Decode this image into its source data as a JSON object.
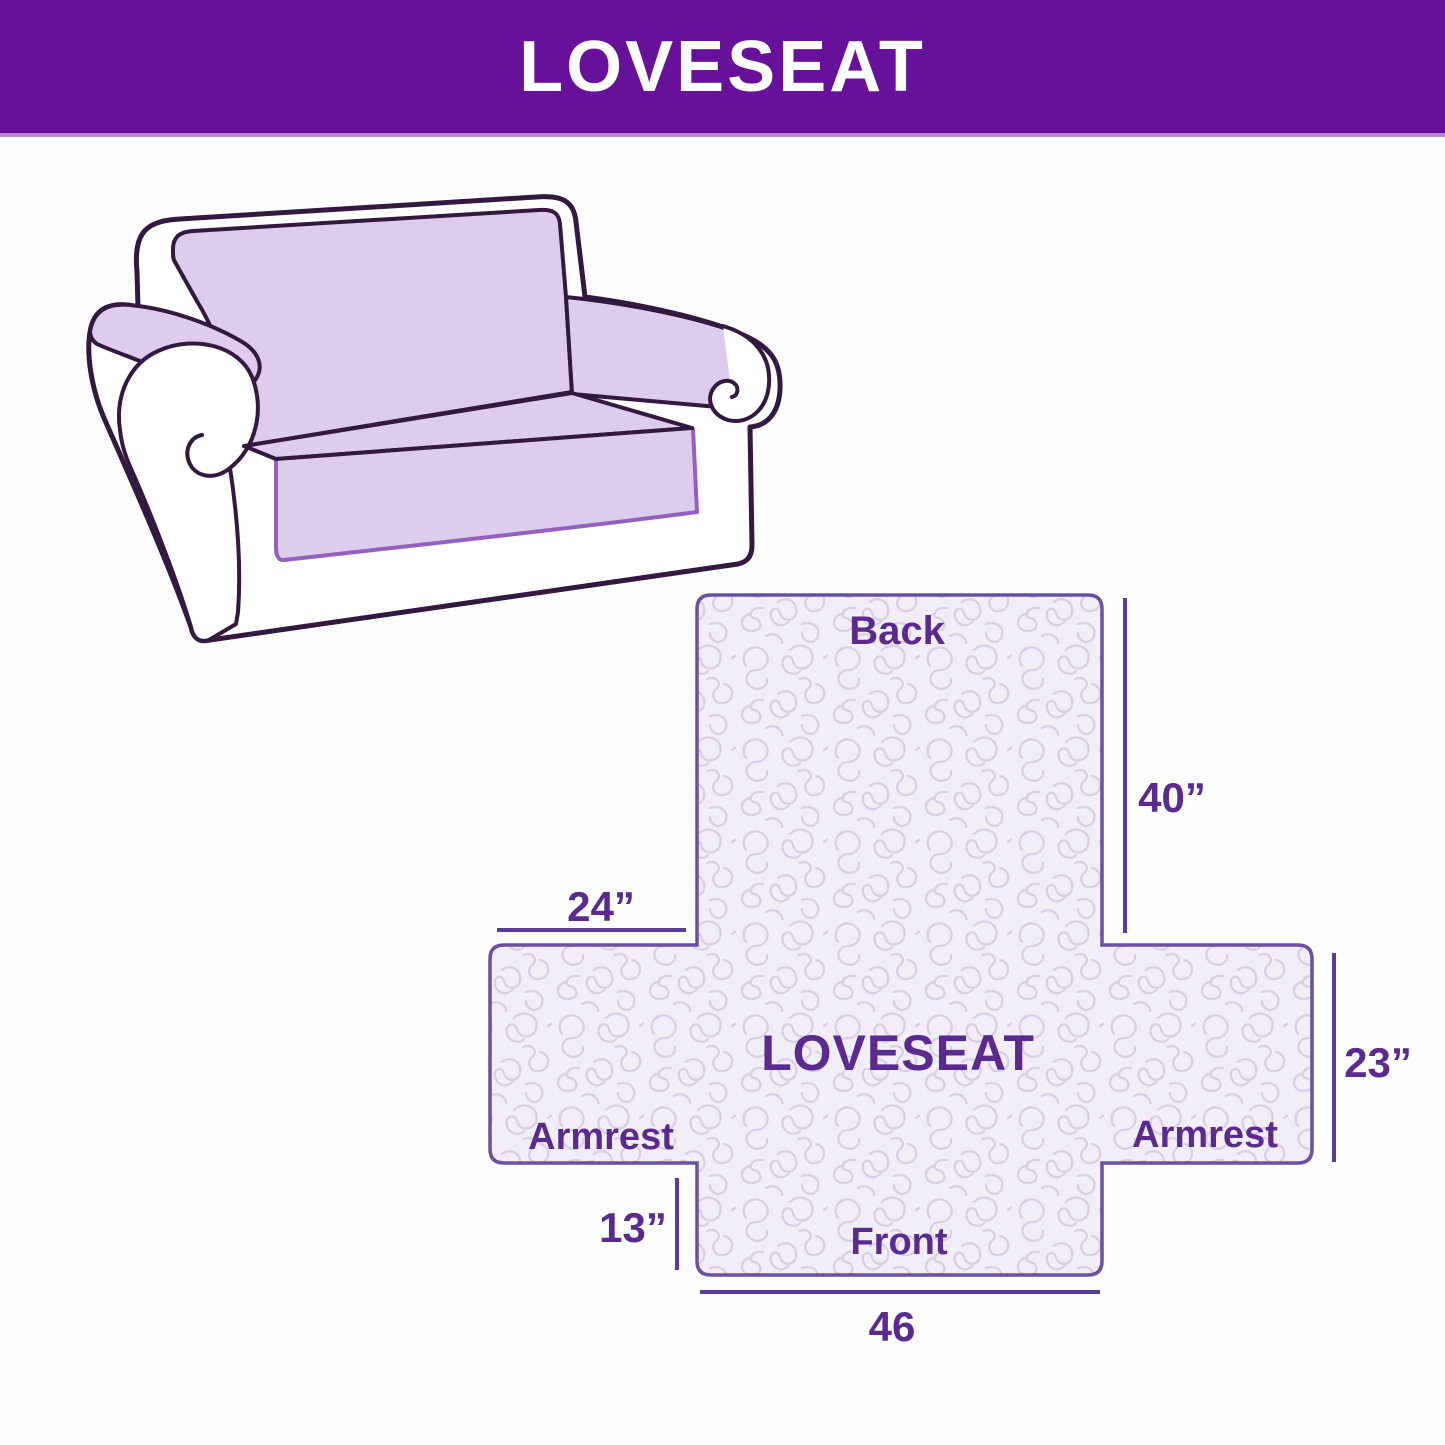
{
  "header": {
    "title": "LOVESEAT"
  },
  "sofa_illustration": {
    "description": "line drawing of a loveseat with quilted slipcover on back, seat and armrests",
    "cover_color": "#ddccee",
    "outline_color": "#33183f",
    "hem_color": "#9361bd"
  },
  "diagram": {
    "center_label": "LOVESEAT",
    "back_label": "Back",
    "front_label": "Front",
    "armrest_left_label": "Armrest",
    "armrest_right_label": "Armrest",
    "dim_back_height": "40”",
    "dim_back_side_width": "24”",
    "dim_armrest_height": "23”",
    "dim_front_drop": "13”",
    "dim_front_width": "46",
    "colors": {
      "header_purple": "#67109a",
      "text_purple": "#5a2a8f",
      "dimension_line_purple": "#5c3a9c",
      "border_purple": "#6b4fa0",
      "quilt_fill": "#f2eef8",
      "quilt_pattern_line": "#d9d0e6"
    }
  }
}
